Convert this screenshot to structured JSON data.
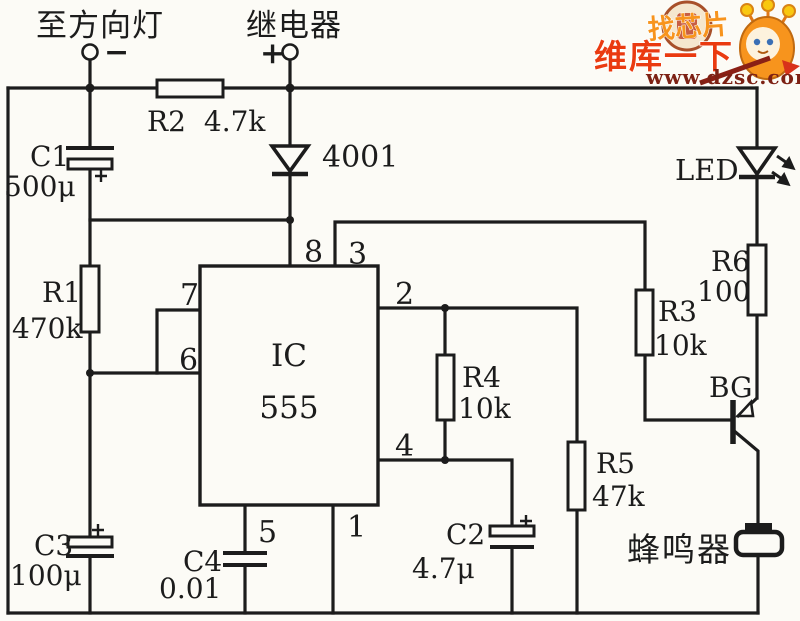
{
  "page": {
    "background": "#fcfbf6",
    "ink": "#1c1c1c"
  },
  "terminals": {
    "left": {
      "label": "至方向灯",
      "polarity": "−"
    },
    "right": {
      "label": "继电器",
      "polarity": "+"
    }
  },
  "ic": {
    "name": "IC",
    "model": "555",
    "pins": {
      "p8": "8",
      "p3": "3",
      "p7": "7",
      "p6": "6",
      "p2": "2",
      "p4": "4",
      "p5": "5",
      "p1": "1"
    }
  },
  "resistors": {
    "r1": {
      "ref": "R1",
      "value": "470k"
    },
    "r2": {
      "ref": "R2",
      "value": "4.7k"
    },
    "r3": {
      "ref": "R3",
      "value": "10k"
    },
    "r4": {
      "ref": "R4",
      "value": "10k"
    },
    "r5": {
      "ref": "R5",
      "value": "47k"
    },
    "r6": {
      "ref": "R6",
      "value": "100"
    }
  },
  "capacitors": {
    "c1": {
      "ref": "C1",
      "value": "500μ"
    },
    "c2": {
      "ref": "C2",
      "value": "4.7μ"
    },
    "c3": {
      "ref": "C3",
      "value": "100μ"
    },
    "c4": {
      "ref": "C4",
      "value": "0.01"
    }
  },
  "diode": {
    "value": "4001"
  },
  "led": {
    "label": "LED"
  },
  "transistor": {
    "label": "BG"
  },
  "buzzer": {
    "label": "蜂鸣器"
  },
  "watermark": {
    "tagline": "找芯片",
    "brand": "维库一下",
    "url": "www.dzsc.com",
    "colors": {
      "orange": "#f7941d",
      "red": "#ea3a10",
      "dark_red": "#7d2114"
    }
  }
}
